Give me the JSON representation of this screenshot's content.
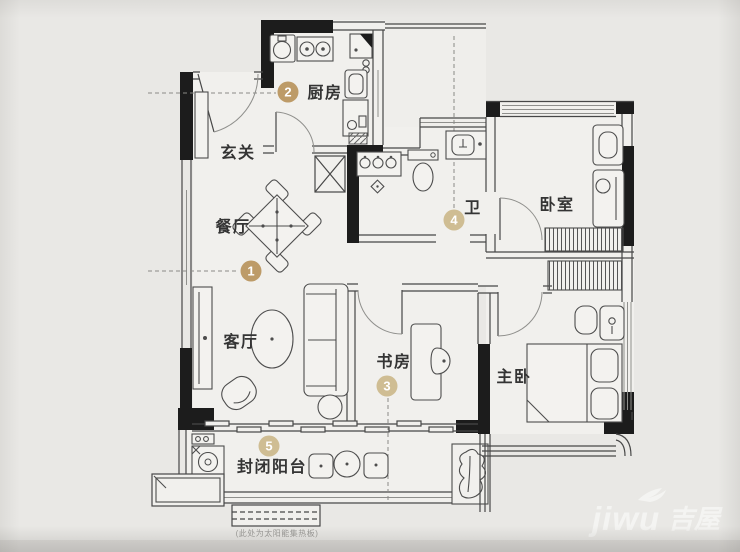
{
  "rooms": {
    "entry": {
      "label": "玄关"
    },
    "kitchen": {
      "label": "厨房",
      "badge": "2"
    },
    "dining": {
      "label": "餐厅",
      "badge": "1"
    },
    "living": {
      "label": "客厅"
    },
    "study": {
      "label": "书房",
      "badge": "3"
    },
    "bath": {
      "label": "卫",
      "badge": "4"
    },
    "bedroom": {
      "label": "卧室"
    },
    "master": {
      "label": "主卧"
    },
    "balcony": {
      "label": "封闭阳台",
      "badge": "5"
    }
  },
  "caption": "(此处为太阳能集热板)",
  "watermark": {
    "latin": "jiwu",
    "cjk": "吉屋"
  },
  "colors": {
    "badge": "#bd9b68",
    "badge_faded": "#cfbd93",
    "wall": "#1c1c1c",
    "background": "#e9e8e5",
    "watermark": "#f7f7f5"
  }
}
